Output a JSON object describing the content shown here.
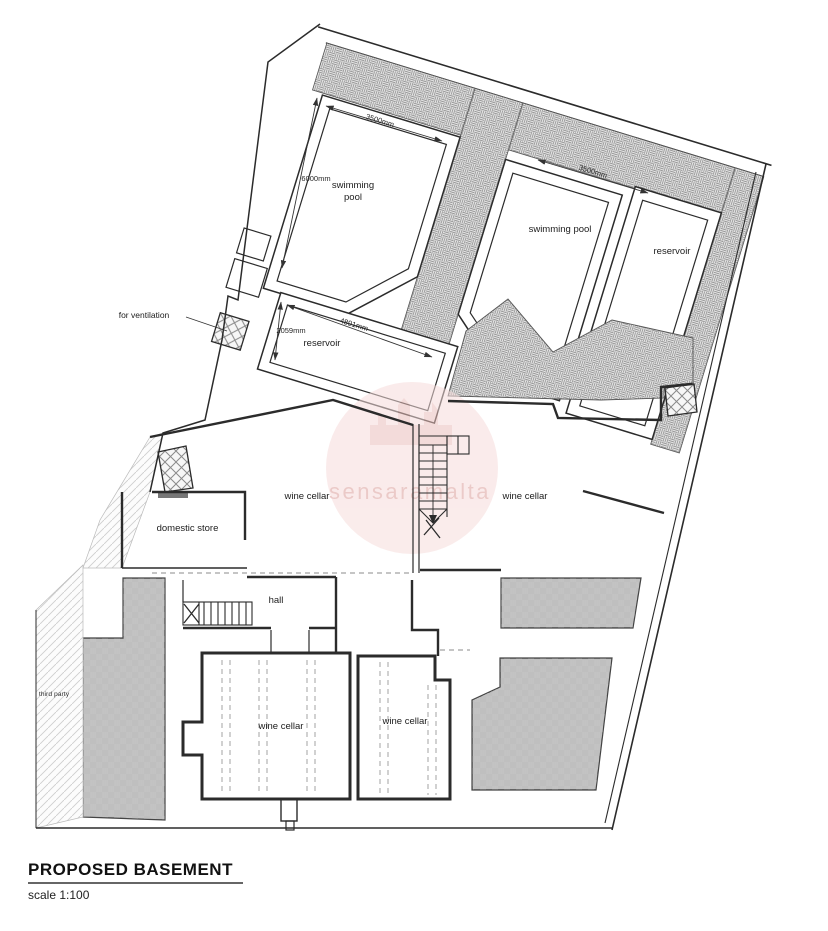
{
  "title": {
    "heading": "PROPOSED BASEMENT",
    "scale": "scale 1:100"
  },
  "watermark": {
    "text": "sensaramalta",
    "circle_color": "#f6dcdb",
    "text_color": "#e2aeab"
  },
  "rooms": {
    "swimming_pool_1": "swimming pool",
    "swimming_pool_2": "swimming pool",
    "reservoir_upper": "reservoir",
    "reservoir_lower": "reservoir",
    "wine_cellar_mid_left": "wine cellar",
    "wine_cellar_mid_right": "wine cellar",
    "domestic_store": "domestic store",
    "hall": "hall",
    "wine_cellar_bottom_left": "wine cellar",
    "wine_cellar_bottom_right": "wine cellar"
  },
  "annotations": {
    "ventilation": "for ventilation",
    "third_party": "third party"
  },
  "dimensions": {
    "pool1_width": "3500mm",
    "pool1_length": "6000mm",
    "pool2_width": "3500mm",
    "reservoir_width": "2059mm",
    "reservoir_length": "4891mm"
  }
}
